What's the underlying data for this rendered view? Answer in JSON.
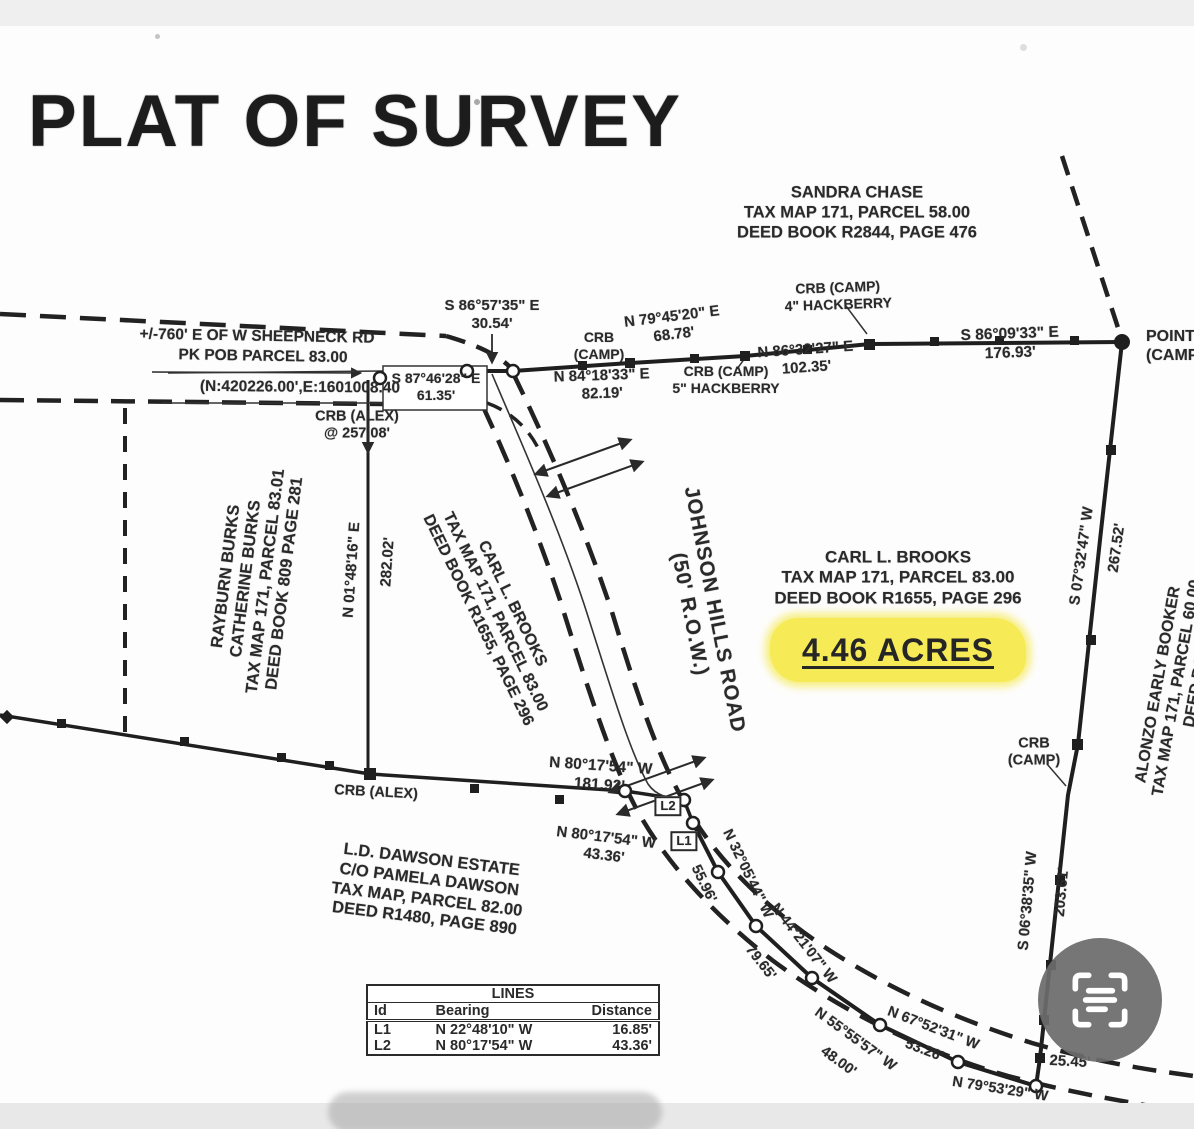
{
  "title": "PLAT OF SURVEY",
  "blocks": {
    "sandra": {
      "l1": "SANDRA CHASE",
      "l2": "TAX MAP 171, PARCEL 58.00",
      "l3": "DEED BOOK R2844, PAGE 476"
    },
    "rayburn": {
      "l1": "RAYBURN BURKS",
      "l2": "CATHERINE BURKS",
      "l3": "TAX MAP 171, PARCEL 83.01",
      "l4": "DEED BOOK 809 PAGE 281"
    },
    "brooks_rot": {
      "l1": "CARL L. BROOKS",
      "l2": "TAX MAP 171, PARCEL 83.00",
      "l3": "DEED BOOK R1655, PAGE 296"
    },
    "brooks": {
      "l1": "CARL L. BROOKS",
      "l2": "TAX MAP 171, PARCEL 83.00",
      "l3": "DEED BOOK R1655, PAGE 296",
      "acres": "4.46 ACRES"
    },
    "dawson": {
      "l1": "L.D. DAWSON ESTATE",
      "l2": "C/O PAMELA DAWSON",
      "l3": "TAX MAP, PARCEL 82.00",
      "l4": "DEED R1480, PAGE 890"
    },
    "booker": {
      "l1": "ALONZO EARLY BOOKER",
      "l2": "TAX MAP 171, PARCEL 60.00",
      "l3": "DEED BO"
    },
    "road": {
      "l1": "JOHNSON HILLS ROAD",
      "l2": "(50' R.O.W.)"
    },
    "point": {
      "l1": "POINT",
      "l2": "(CAMPB"
    }
  },
  "notes": {
    "sheepneck": "+/-760' E OF W SHEEPNECK RD",
    "pkpob": "PK POB PARCEL 83.00",
    "coords": "(N:420226.00',E:1601008.40",
    "crb_alex1": {
      "l1": "CRB (ALEX)",
      "l2": "@ 257.08'"
    },
    "crb_alex2": "CRB (ALEX)",
    "crb_camp1": {
      "l1": "CRB",
      "l2": "(CAMP)"
    },
    "hack5": {
      "l1": "CRB (CAMP)",
      "l2": "5\" HACKBERRY"
    },
    "hack4": {
      "l1": "CRB (CAMP)",
      "l2": "4\" HACKBERRY"
    },
    "crb_camp2": {
      "l1": "CRB",
      "l2": "(CAMP)"
    },
    "l1": "L1",
    "l2": "L2"
  },
  "bearings": {
    "s865735": {
      "b": "S 86°57'35\" E",
      "d": "30.54'"
    },
    "s874628": {
      "b": "S 87°46'28\" E",
      "d": "61.35'"
    },
    "n841833": {
      "b": "N 84°18'33\" E",
      "d": "82.19'"
    },
    "n794520": {
      "b": "N 79°45'20\" E",
      "d": "68.78'"
    },
    "n863227": {
      "b": "N 86°32'27\" E",
      "d": "102.35'"
    },
    "s860933": {
      "b": "S 86°09'33\" E",
      "d": "176.93'"
    },
    "s073247": {
      "b": "S 07°32'47\" W",
      "d": "267.52'"
    },
    "s063835": {
      "b": "S 06°38'35\" W",
      "d": "203.61'"
    },
    "n014816": {
      "b": "N 01°48'16\" E",
      "d": "282.02'"
    },
    "n801754a": {
      "b": "N 80°17'54\" W",
      "d": "181.92'"
    },
    "n801754b": {
      "b": "N 80°17'54\" W",
      "d": "43.36'"
    },
    "n320544": {
      "b": "N 32°05'44\" W",
      "d": "55.96'"
    },
    "n442107": {
      "b": "N 44°21'07\" W",
      "d": "79.65'"
    },
    "n555557": {
      "b": "N 55°55'57\" W",
      "d": "48.00'"
    },
    "n675231": {
      "b": "N 67°52'31\" W",
      "d": "53.26'"
    },
    "n795329": {
      "b": "N 79°53'29\" W",
      "d": ""
    },
    "d2545": "25.45'"
  },
  "table": {
    "title": "LINES",
    "headers": {
      "id": "Id",
      "bearing": "Bearing",
      "distance": "Distance"
    },
    "rows": [
      {
        "id": "L1",
        "bearing": "N 22°48'10\" W",
        "dist": "16.85'"
      },
      {
        "id": "L2",
        "bearing": "N 80°17'54\" W",
        "dist": "43.36'"
      }
    ]
  },
  "colors": {
    "highlight": "#f6ea57",
    "ink": "#2a2a2a",
    "icon_bg": "#6c6c6c"
  }
}
